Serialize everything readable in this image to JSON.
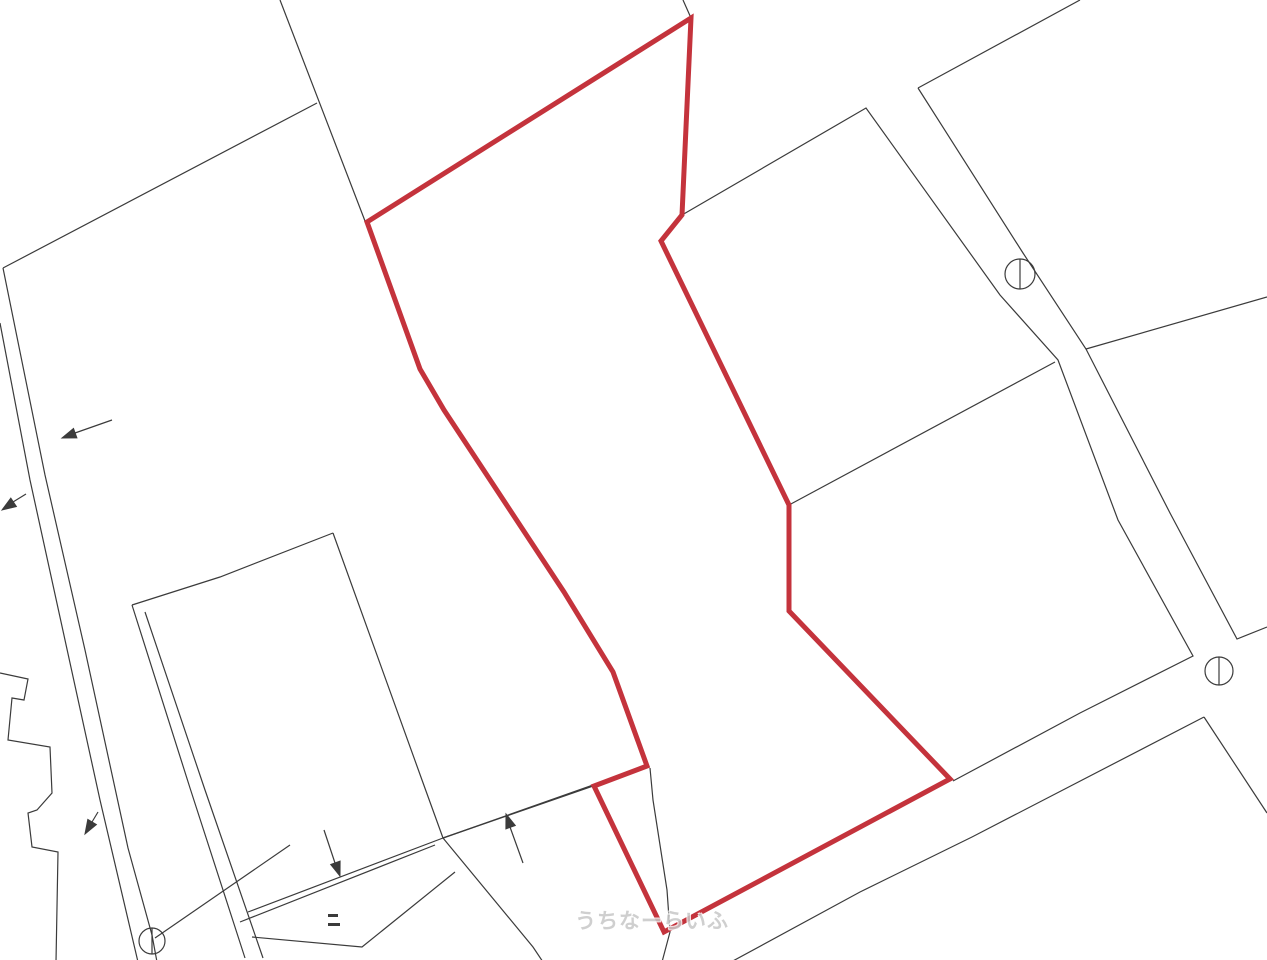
{
  "map": {
    "kind": "cadastral-parcel-map",
    "background_color": "#ffffff",
    "boundary_color": "#3b3b3b",
    "boundary_stroke_width": 1.2,
    "parcel_color": "#c4333c",
    "parcel_stroke_width": 5,
    "watermark": {
      "text": "うちなーらいふ",
      "color": "#c7c7c7"
    },
    "selected_parcel": {
      "points": "691,18 682,215 661,241 789,505 789,611 950,779 664,932 594,786 647,766 613,672 564,592 444,410 420,369 367,222"
    },
    "boundary_lines": [
      {
        "points": "683,0 691,18"
      },
      {
        "points": "682,215 866,108 1000,295 1058,360 1118,520 1193,656 1080,713 953,781"
      },
      {
        "points": "918,88 1080,0"
      },
      {
        "points": "918,88 1023,253 1086,349 1170,513 1237,639 1267,627"
      },
      {
        "points": "1086,349 1267,297"
      },
      {
        "points": "789,505 1055,362"
      },
      {
        "points": "731,962 860,892 972,837 1204,717"
      },
      {
        "points": "1204,717 1267,813"
      },
      {
        "points": "280,0 365,221"
      },
      {
        "points": "317,103 3,268"
      },
      {
        "points": "3,268 45,475 85,650 128,848 152,935 157,962"
      },
      {
        "points": "0,323 30,480 65,640 100,800 138,962"
      },
      {
        "points": "132,605 220,577 333,533"
      },
      {
        "points": "333,533 422,780 443,838"
      },
      {
        "points": "443,838 593,786"
      },
      {
        "points": "443,838 630,772"
      },
      {
        "points": "443,838 248,912"
      },
      {
        "points": "435,845 240,922"
      },
      {
        "points": "252,937 362,947 455,872"
      },
      {
        "points": "443,838 533,947 543,962"
      },
      {
        "points": "132,605 190,788 245,958"
      },
      {
        "points": "145,612 205,790 263,958"
      },
      {
        "points": "290,845 155,938"
      },
      {
        "points": "0,673 28,679 24,700 12,698 8,740 50,747 52,793 37,810 28,813 32,847 58,852 56,962"
      },
      {
        "points": "650,768 653,800 667,890 670,932 662,962"
      }
    ],
    "survey_markers": [
      {
        "cx": 1020,
        "cy": 274,
        "r": 15,
        "diameter": "1020,259 1020,289"
      },
      {
        "cx": 1219,
        "cy": 671,
        "r": 14,
        "diameter": "1219,657 1219,685"
      },
      {
        "cx": 152,
        "cy": 941,
        "r": 13,
        "diameter": "152,928 152,954"
      }
    ],
    "arrows": [
      {
        "tail": "112,420 75,433",
        "head": "62,438 73.5,428.5 76.9,437.9"
      },
      {
        "tail": "26,494 13,502",
        "head": "2,510 10.8,498.1 16.4,506.5"
      },
      {
        "tail": "98,812 92,822",
        "head": "85,834 87.8,819.4 96.4,824.6"
      },
      {
        "tail": "324,830 335,863",
        "head": "340,876 330.7,864.5 340.1,861.1"
      },
      {
        "tail": "523,863 510,827",
        "head": "506,814 515.3,825.5 505.9,828.9"
      }
    ],
    "ticks": [
      {
        "x": 328,
        "y": 914,
        "w": 10,
        "h": 3
      },
      {
        "x": 328,
        "y": 923,
        "w": 12,
        "h": 3
      }
    ]
  }
}
